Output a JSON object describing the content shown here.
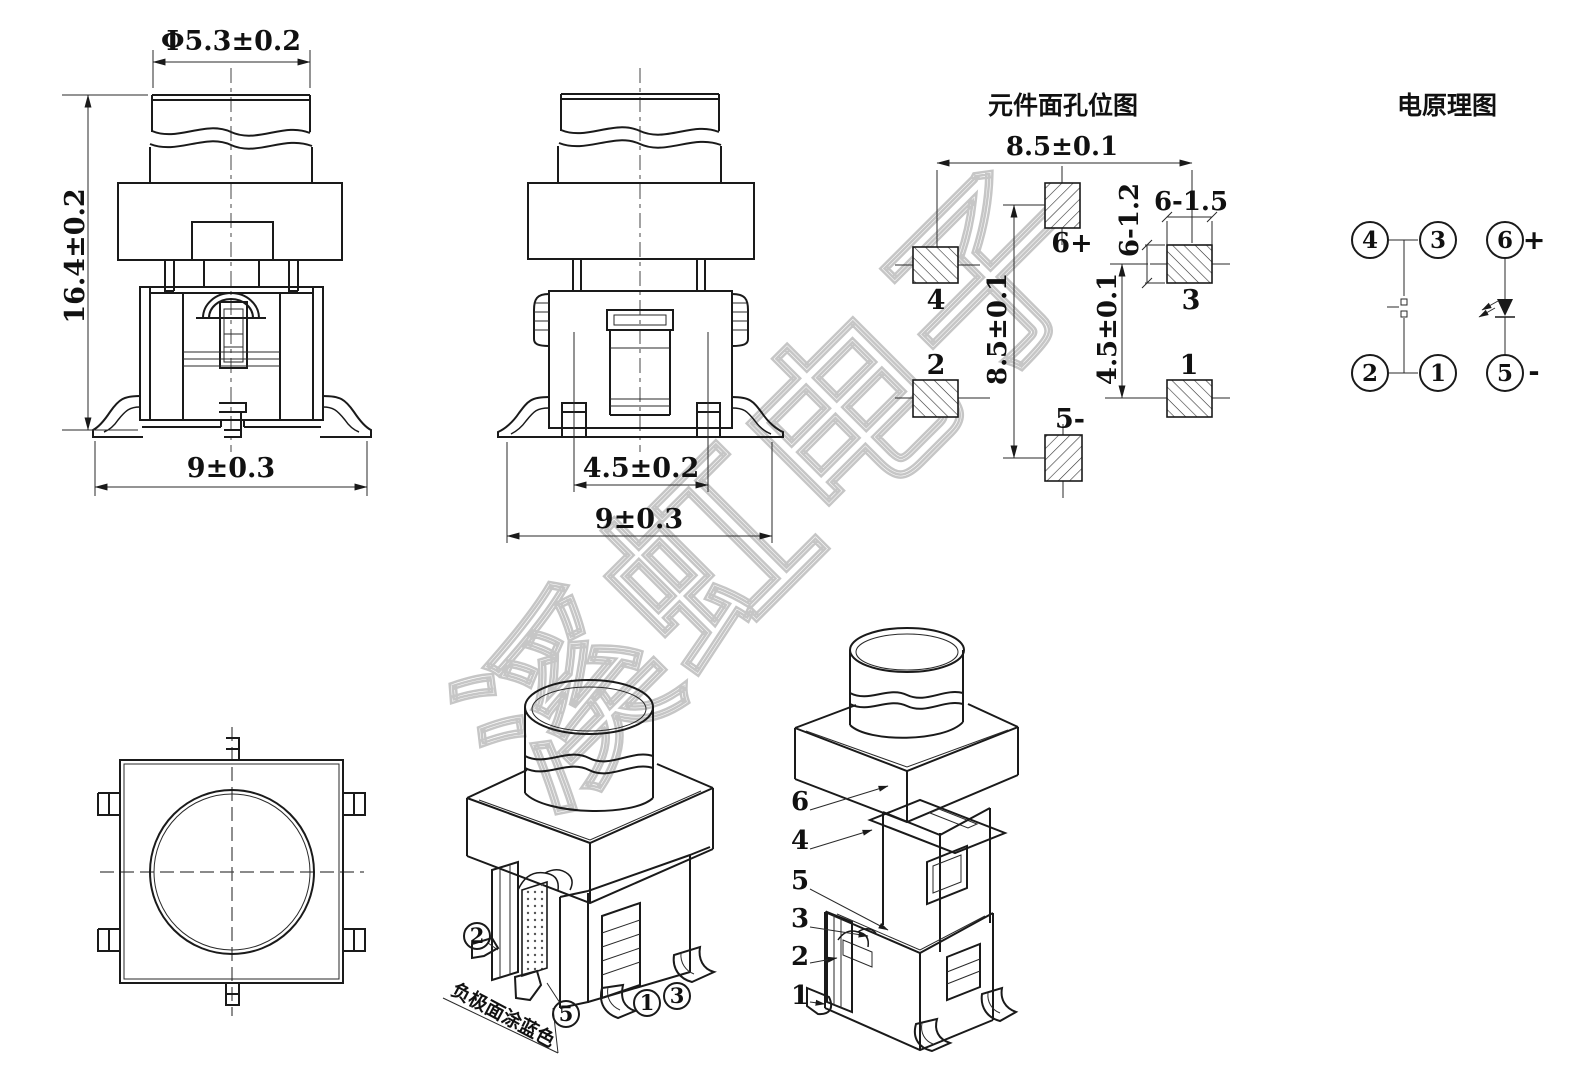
{
  "front_view": {
    "dim_diameter": "Φ5.3±0.2",
    "dim_height": "16.4±0.2",
    "dim_width": "9±0.3"
  },
  "side_view": {
    "dim_terminal_pitch": "4.5±0.2",
    "dim_width": "9±0.3"
  },
  "pad_layout": {
    "title": "元件面孔位图",
    "dim_horizontal_span": "8.5±0.1",
    "dim_vertical_span": "8.5±0.1",
    "dim_vertical_pitch": "4.5±0.1",
    "dim_hole_width": "6-1.5",
    "dim_hole_height": "6-1.2",
    "pads": [
      {
        "label": "4"
      },
      {
        "label": "2"
      },
      {
        "label": "6+"
      },
      {
        "label": "5-"
      },
      {
        "label": "3"
      },
      {
        "label": "1"
      }
    ]
  },
  "schematic": {
    "title": "电原理图",
    "pins": [
      "4",
      "3",
      "6",
      "2",
      "1",
      "5"
    ],
    "plus": "+",
    "minus": "-"
  },
  "iso_front_view": {
    "callouts": [
      "2",
      "5",
      "1",
      "3"
    ],
    "note": "负极面涂蓝色"
  },
  "iso_back_view": {
    "callouts": [
      "6",
      "4",
      "5",
      "3",
      "2",
      "1"
    ]
  },
  "watermark": {
    "text": "溪虹电子"
  },
  "colors": {
    "line": "#1a1a1a",
    "watermark_outline": "#c6c6c6",
    "paper": "#ffffff"
  }
}
